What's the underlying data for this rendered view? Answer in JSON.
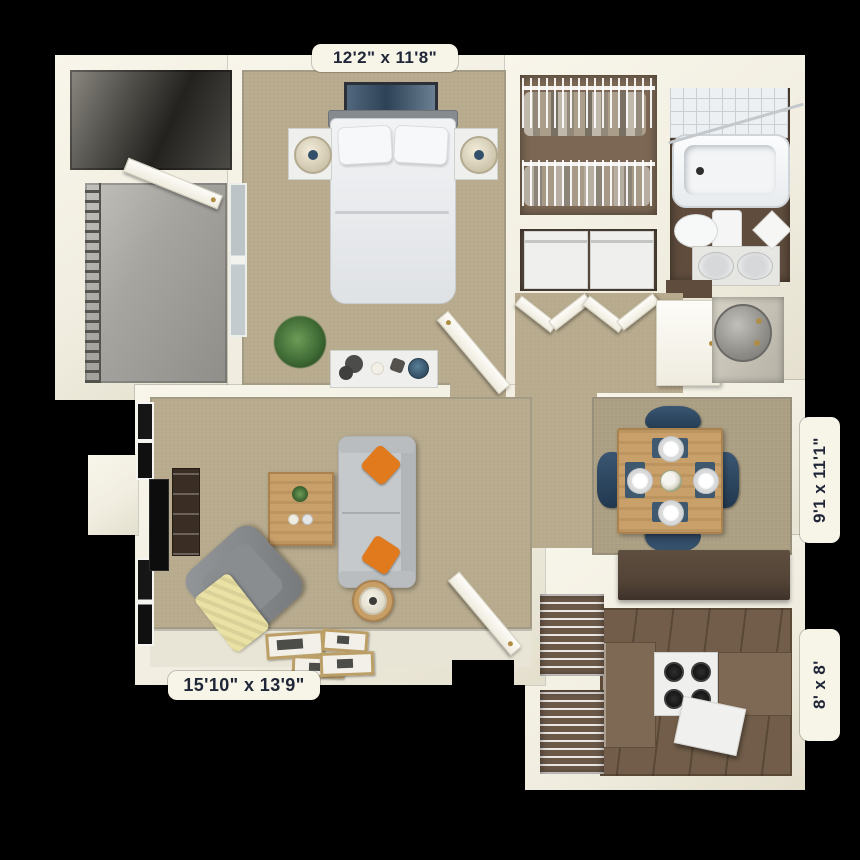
{
  "plan": {
    "type": "3d-apartment-floor-plan",
    "rooms": [
      {
        "id": "bedroom",
        "dimension_label": "12'2\" x 11'8\""
      },
      {
        "id": "dining",
        "dimension_label": "9'1 x 11'1\""
      },
      {
        "id": "kitchen",
        "dimension_label": "8' x 8'"
      },
      {
        "id": "living",
        "dimension_label": "15'10\" x 13'9\""
      }
    ]
  },
  "labels": {
    "bedroom_dim": "12'2\" x 11'8\"",
    "dining_dim": "9'1 x 11'1\"",
    "kitchen_dim": "8' x 8'",
    "living_dim": "15'10\" x 13'9\""
  },
  "colors": {
    "background": "#000000",
    "wall": "#f1eee1",
    "carpet": "#b7aa8d",
    "carpet_dining": "#ab9f83",
    "wood_floor": "#715d49",
    "tile_entry": "#e9e5d6",
    "patio_concrete": "#a9a8a2",
    "bath_floor": "#5f4c3d",
    "closet_floor": "#7b6753",
    "counter_brown": "#544437",
    "table_wood": "#c9a06a",
    "sofa_gray": "#c6c9cb",
    "pillow_orange": "#e07a1c",
    "chair_navy": "#31516f",
    "throw_yellow": "#eae1a4",
    "label_bg": "#f7f4e8",
    "label_text": "#1f2637"
  }
}
